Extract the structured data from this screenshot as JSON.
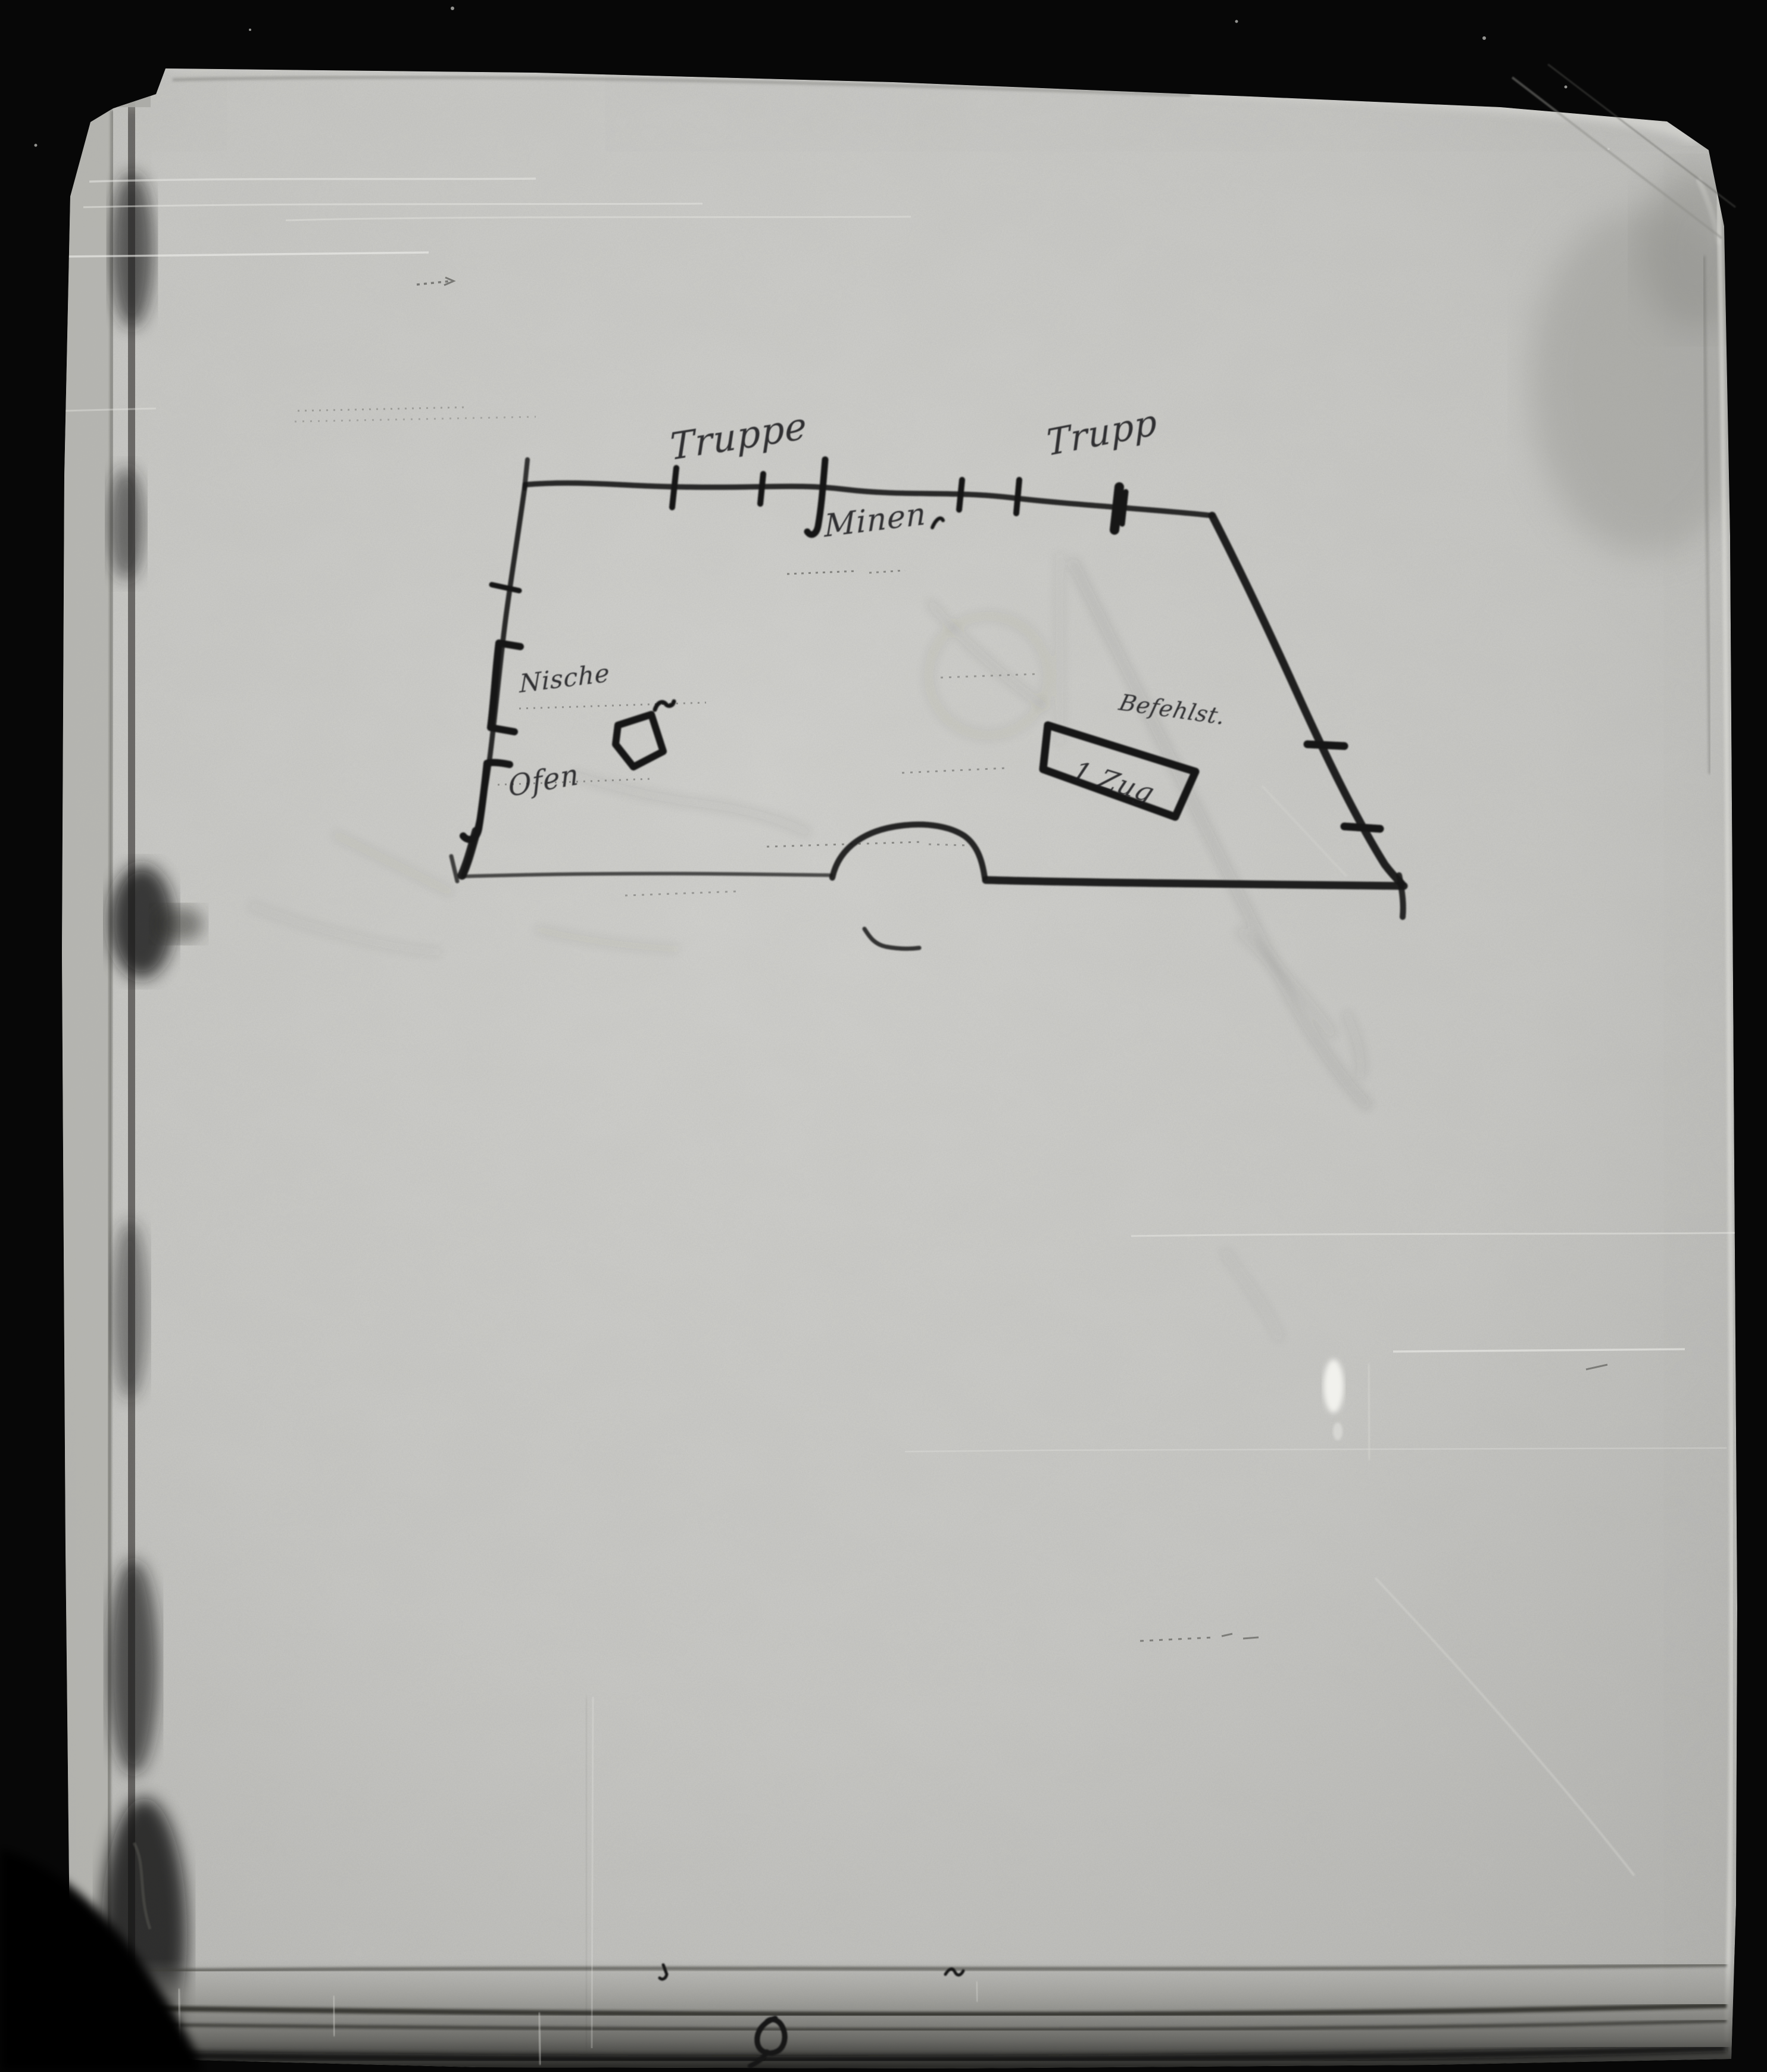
{
  "photo": {
    "background_color": "#070707",
    "paper_color": "#c6c6c3",
    "paper_shadow_color": "#44433f",
    "ink_color": "#141414"
  },
  "annotations": {
    "top_left_label": "Truppe",
    "top_right_label": "Trupp",
    "below_top_wall_label": "Minen",
    "left_wall_upper_label": "Nische",
    "left_wall_lower_label": "Ofen",
    "box_caption_label": "Befehlst.",
    "box_inner_label": "1 Zug"
  }
}
